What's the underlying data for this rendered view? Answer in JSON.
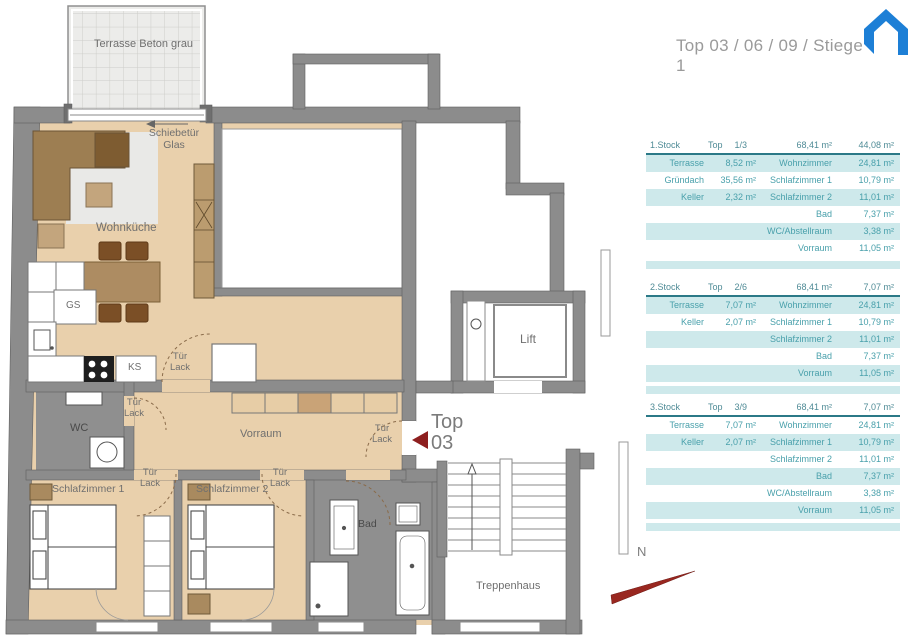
{
  "header": {
    "title": "Top 03 / 06 / 09 / Stiege 1",
    "logo_icon": "house-icon",
    "logo_color": "#1d7fd6"
  },
  "plan": {
    "labels": {
      "terrasse": "Terrasse Beton grau",
      "schiebetuer_1": "Schiebetür",
      "schiebetuer_2": "Glas",
      "wohnkueche": "Wohnküche",
      "gs": "GS",
      "ks": "KS",
      "wc": "WC",
      "vorraum": "Vorraum",
      "schlafzimmer1": "Schlafzimmer 1",
      "schlafzimmer2": "Schlafzimmer 2",
      "bad": "Bad",
      "top_1": "Top",
      "top_2": "03",
      "lift": "Lift",
      "treppenhaus": "Treppenhaus",
      "tuer": "Tür",
      "lack": "Lack",
      "compass_n": "N"
    },
    "colors": {
      "wall": "#8c8c8c",
      "floor": "#e9d0ac",
      "wet_room_floor": "#8f8f8f",
      "terrace": "#ececea",
      "entry_marker_red": "#8e1f1f",
      "compass_needle": "#992720"
    }
  },
  "tables": [
    {
      "floor": "1.Stock",
      "top_label": "Top",
      "top_value": "1/3",
      "total_living": "68,41 m²",
      "total_extra": "44,08 m²",
      "rows": [
        {
          "a": "Terrasse",
          "av": "8,52 m²",
          "b": "Wohnzimmer",
          "bv": "24,81 m²"
        },
        {
          "a": "Gründach",
          "av": "35,56 m²",
          "b": "Schlafzimmer 1",
          "bv": "10,79 m²"
        },
        {
          "a": "Keller",
          "av": "2,32 m²",
          "b": "Schlafzimmer 2",
          "bv": "11,01 m²"
        },
        {
          "a": "",
          "av": "",
          "b": "Bad",
          "bv": "7,37 m²"
        },
        {
          "a": "",
          "av": "",
          "b": "WC/Abstellraum",
          "bv": "3,38 m²"
        },
        {
          "a": "",
          "av": "",
          "b": "Vorraum",
          "bv": "11,05 m²"
        }
      ]
    },
    {
      "floor": "2.Stock",
      "top_label": "Top",
      "top_value": "2/6",
      "total_living": "68,41 m²",
      "total_extra": "7,07 m²",
      "rows": [
        {
          "a": "Terrasse",
          "av": "7,07 m²",
          "b": "Wohnzimmer",
          "bv": "24,81 m²"
        },
        {
          "a": "Keller",
          "av": "2,07 m²",
          "b": "Schlafzimmer 1",
          "bv": "10,79 m²"
        },
        {
          "a": "",
          "av": "",
          "b": "Schlafzimmer 2",
          "bv": "11,01 m²"
        },
        {
          "a": "",
          "av": "",
          "b": "Bad",
          "bv": "7,37 m²"
        },
        {
          "a": "",
          "av": "",
          "b": "Vorraum",
          "bv": "11,05 m²"
        }
      ]
    },
    {
      "floor": "3.Stock",
      "top_label": "Top",
      "top_value": "3/9",
      "total_living": "68,41 m²",
      "total_extra": "7,07 m²",
      "rows": [
        {
          "a": "Terrasse",
          "av": "7,07 m²",
          "b": "Wohnzimmer",
          "bv": "24,81 m²"
        },
        {
          "a": "Keller",
          "av": "2,07 m²",
          "b": "Schlafzimmer 1",
          "bv": "10,79 m²"
        },
        {
          "a": "",
          "av": "",
          "b": "Schlafzimmer 2",
          "bv": "11,01 m²"
        },
        {
          "a": "",
          "av": "",
          "b": "Bad",
          "bv": "7,37 m²"
        },
        {
          "a": "",
          "av": "",
          "b": "WC/Abstellraum",
          "bv": "3,38 m²"
        },
        {
          "a": "",
          "av": "",
          "b": "Vorraum",
          "bv": "11,05 m²"
        }
      ]
    }
  ]
}
